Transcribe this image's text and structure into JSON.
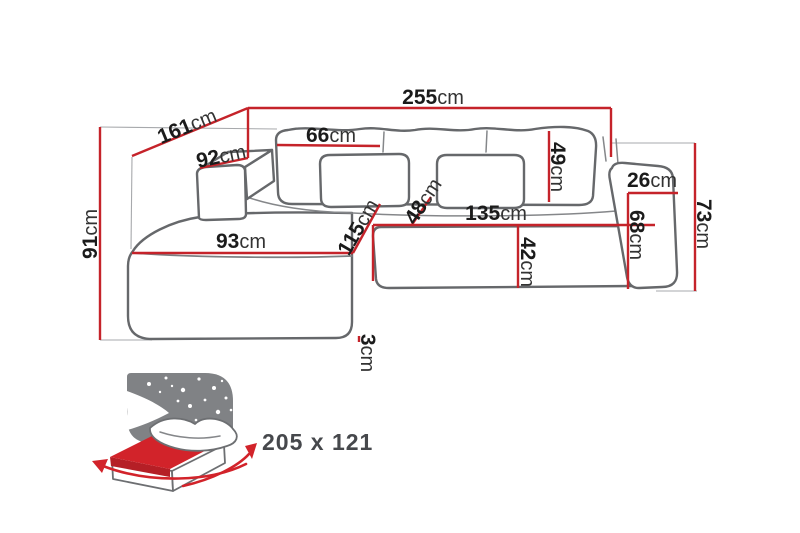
{
  "diagram": {
    "title": "corner-sofa-dimensions",
    "colors": {
      "dimension_red": "#c5232a",
      "outline_gray": "#66686b",
      "icon_gray": "#808285",
      "text_black": "#1b1b1b"
    },
    "dimensions": {
      "d255": {
        "value": "255",
        "unit": "cm"
      },
      "d161": {
        "value": "161",
        "unit": "cm"
      },
      "d91": {
        "value": "91",
        "unit": "cm"
      },
      "d92": {
        "value": "92",
        "unit": "cm"
      },
      "d66": {
        "value": "66",
        "unit": "cm"
      },
      "d49": {
        "value": "49",
        "unit": "cm"
      },
      "d26": {
        "value": "26",
        "unit": "cm"
      },
      "d68": {
        "value": "68",
        "unit": "cm"
      },
      "d73": {
        "value": "73",
        "unit": "cm"
      },
      "d135": {
        "value": "135",
        "unit": "cm"
      },
      "d42": {
        "value": "42",
        "unit": "cm"
      },
      "d115": {
        "value": "115",
        "unit": "cm"
      },
      "d48": {
        "value": "48",
        "unit": "cm"
      },
      "d93": {
        "value": "93",
        "unit": "cm"
      },
      "d3": {
        "value": "3",
        "unit": "cm"
      }
    },
    "sleeping_area": {
      "label": "205 x 121"
    }
  }
}
